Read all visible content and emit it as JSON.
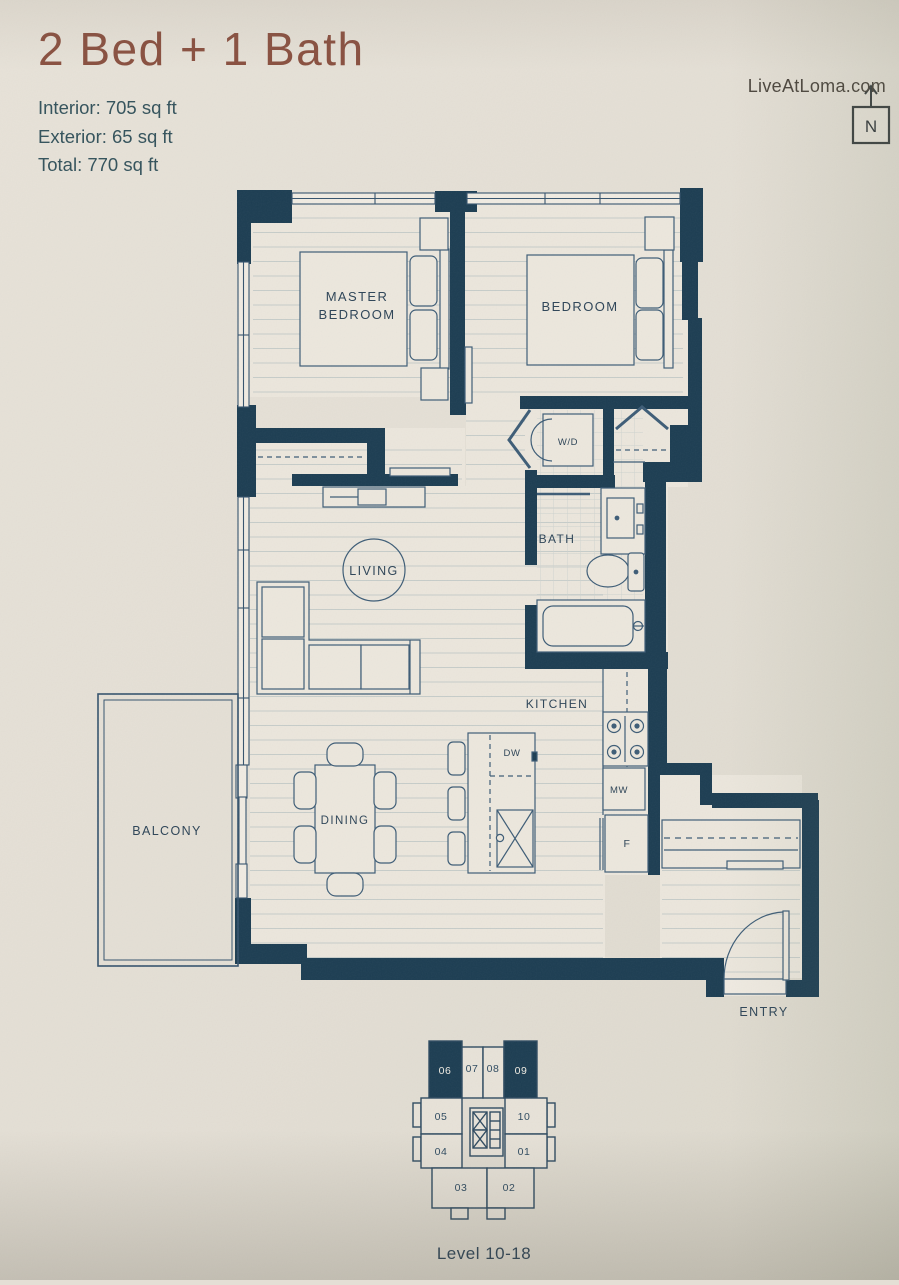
{
  "header": {
    "title": "2 Bed + 1 Bath",
    "website": "LiveAtLoma.com",
    "stats": {
      "interior": "Interior: 705 sq ft",
      "exterior": "Exterior: 65 sq ft",
      "total": "Total: 770 sq ft"
    }
  },
  "compass": {
    "label": "N"
  },
  "rooms": {
    "master_line1": "MASTER",
    "master_line2": "BEDROOM",
    "bedroom": "BEDROOM",
    "living": "LIVING",
    "dining": "DINING",
    "kitchen": "KITCHEN",
    "bath": "BATH",
    "balcony": "BALCONY",
    "entry": "ENTRY",
    "wd": "W/D"
  },
  "appliances": {
    "dw": "DW",
    "mw": "MW",
    "fridge": "F"
  },
  "keyplan": {
    "level": "Level 10-18",
    "units": [
      {
        "no": "06",
        "highlighted": true
      },
      {
        "no": "07",
        "highlighted": false
      },
      {
        "no": "08",
        "highlighted": false
      },
      {
        "no": "09",
        "highlighted": true
      },
      {
        "no": "05",
        "highlighted": false
      },
      {
        "no": "10",
        "highlighted": false
      },
      {
        "no": "04",
        "highlighted": false
      },
      {
        "no": "01",
        "highlighted": false
      },
      {
        "no": "03",
        "highlighted": false
      },
      {
        "no": "02",
        "highlighted": false
      }
    ]
  },
  "colors": {
    "wall": "#1c3d52",
    "line": "#3d5c76",
    "title_accent": "#8a5242",
    "stats_text": "#37555e",
    "paper": "#e4dfd5"
  }
}
